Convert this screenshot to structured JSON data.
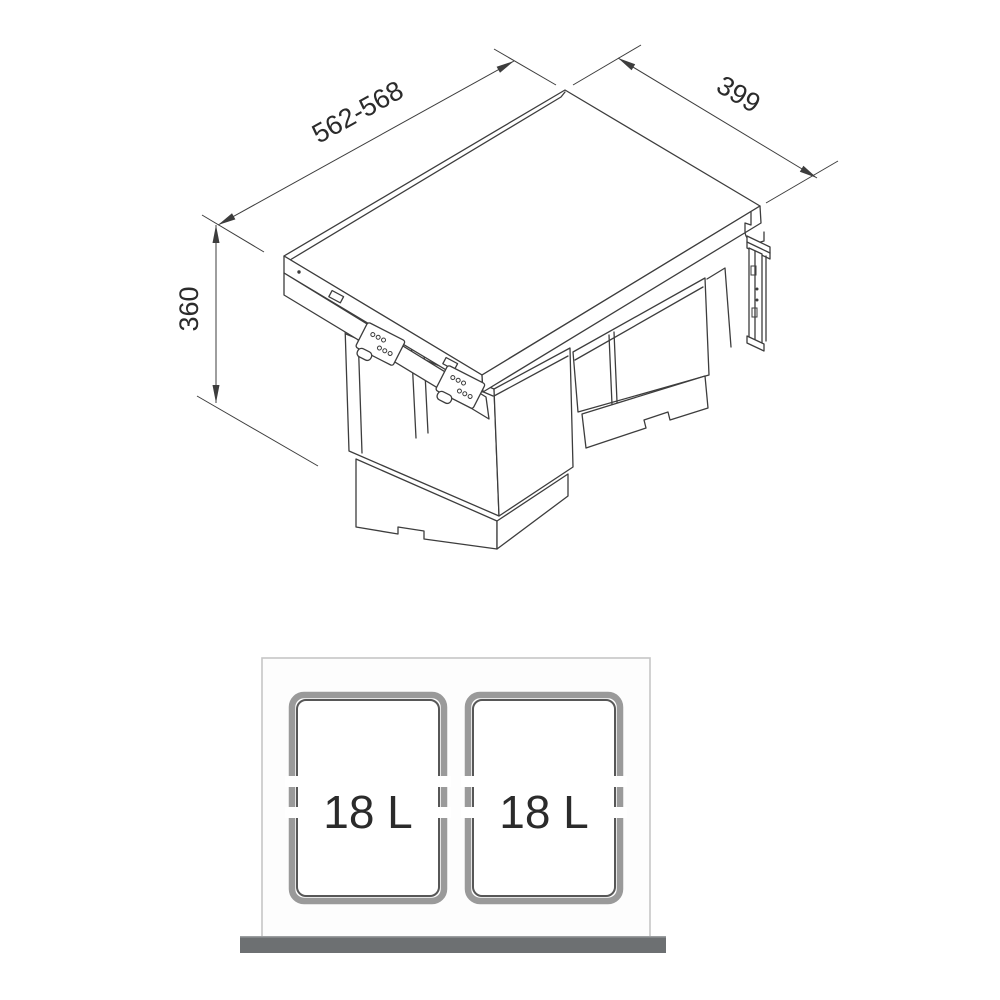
{
  "product_diagram": {
    "type": "technical-dimension-drawing",
    "subject": "pull-out double waste bin",
    "dimensions": {
      "width": "562-568",
      "depth": "399",
      "height": "360"
    },
    "top_view": {
      "bins": [
        {
          "capacity": "18 L"
        },
        {
          "capacity": "18 L"
        }
      ]
    },
    "colors": {
      "line": "#3d3d3d",
      "panel_outline": "#c6c6c6",
      "bin_border_outer": "#9a9a9a",
      "bin_border_inner": "#575757",
      "front_bar": "#6d7072",
      "label_text": "#2b2b2b"
    }
  }
}
